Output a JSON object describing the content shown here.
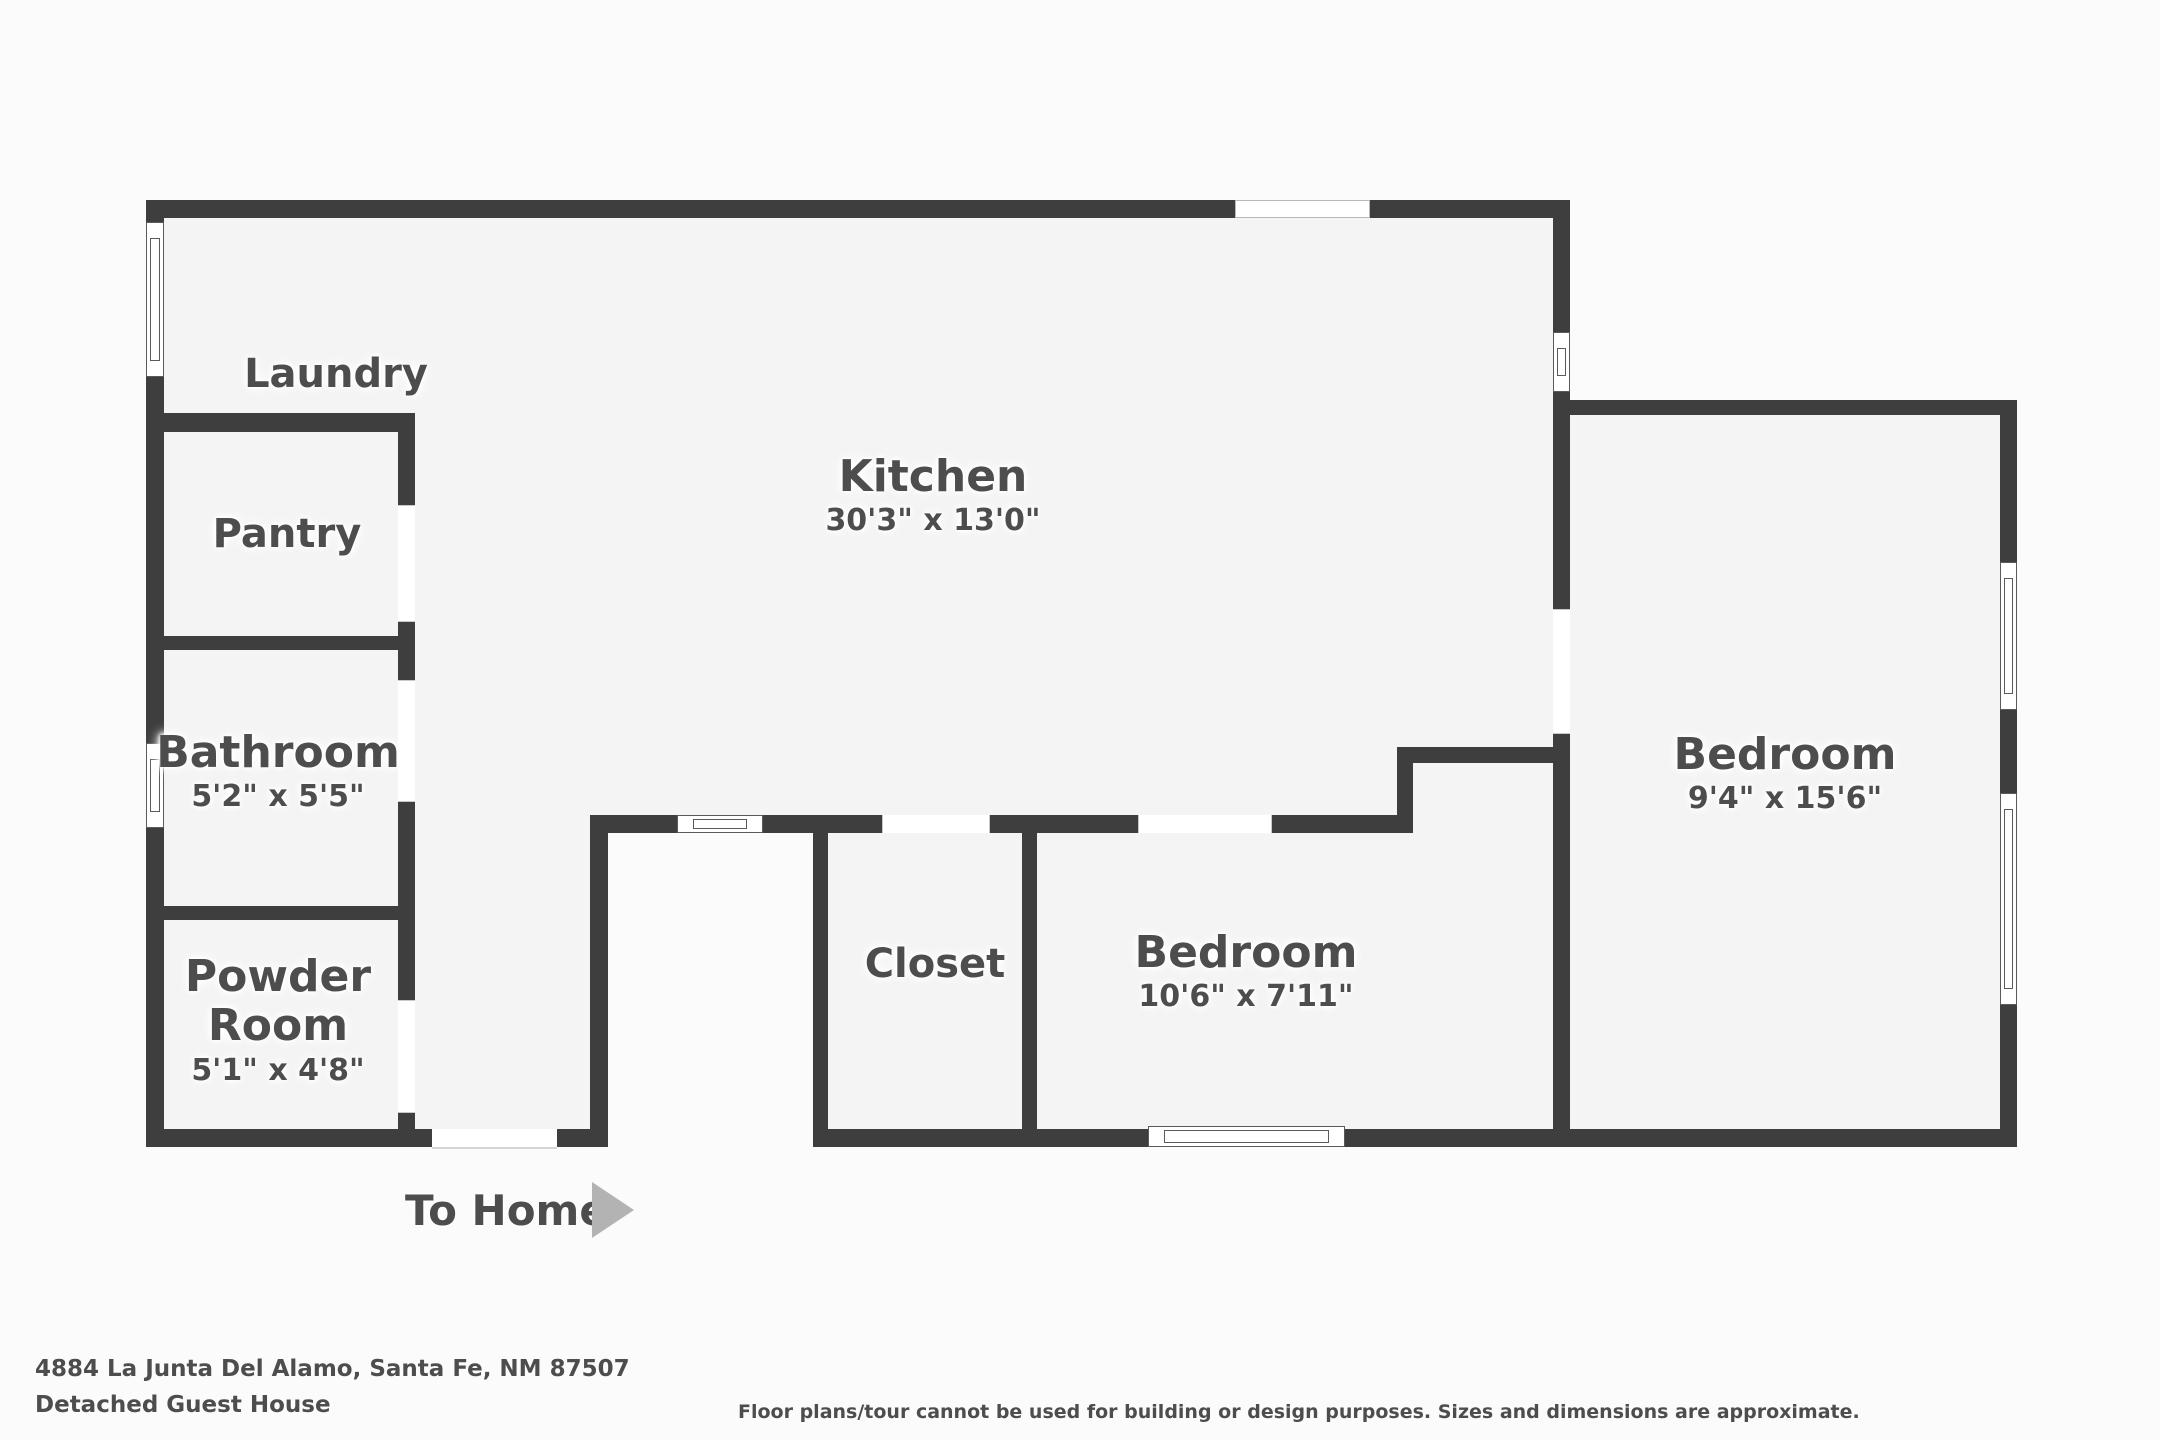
{
  "plan": {
    "rooms": [
      {
        "id": "laundry",
        "name": "Laundry",
        "dims": ""
      },
      {
        "id": "pantry",
        "name": "Pantry",
        "dims": ""
      },
      {
        "id": "kitchen",
        "name": "Kitchen",
        "dims": "30'3\" x 13'0\""
      },
      {
        "id": "bathroom",
        "name": "Bathroom",
        "dims": "5'2\" x 5'5\""
      },
      {
        "id": "powder",
        "name": "Powder Room",
        "dims": "5'1\" x 4'8\""
      },
      {
        "id": "closet",
        "name": "Closet",
        "dims": ""
      },
      {
        "id": "bedroom2",
        "name": "Bedroom",
        "dims": "10'6\" x 7'11\""
      },
      {
        "id": "bedroom1",
        "name": "Bedroom",
        "dims": "9'4\" x 15'6\""
      }
    ],
    "exit_label": "To Home"
  },
  "footer": {
    "address": "4884 La Junta Del Alamo, Santa Fe, NM 87507",
    "subtitle": "Detached Guest House",
    "disclaimer": "Floor plans/tour cannot be used for building or design purposes. Sizes and dimensions are approximate."
  },
  "colors": {
    "wall": "#3e3e3e",
    "floor": "#f4f4f4",
    "background": "#fbfbfb",
    "text": "#4d4d4d",
    "arrow": "#b3b3b3"
  }
}
